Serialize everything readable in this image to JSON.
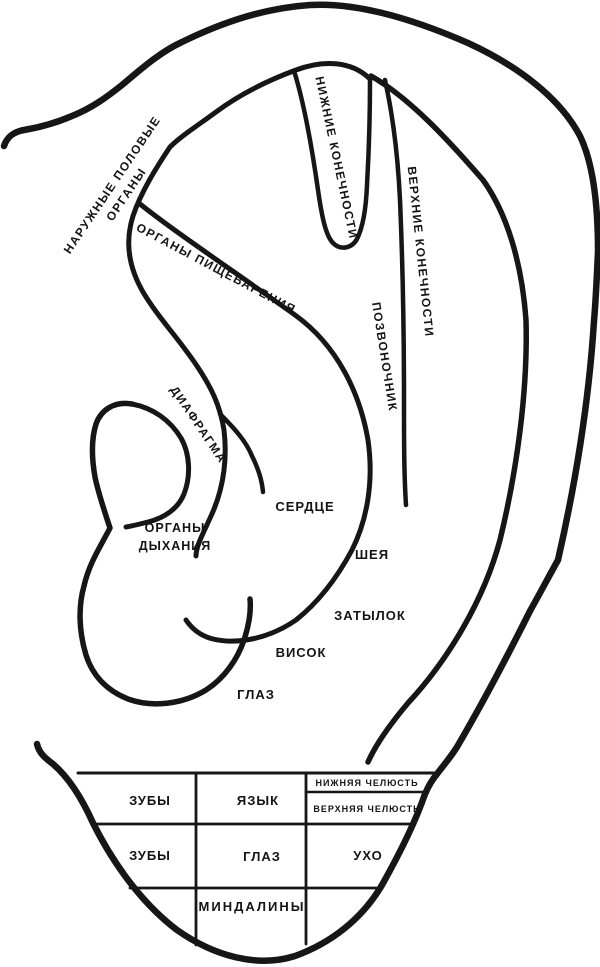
{
  "figure": {
    "description": "Ear reflexology zone map (auriculotherapy diagram of the auricle)",
    "language": "ru"
  },
  "colors": {
    "ink": "#161616",
    "background": "#ffffff"
  },
  "zone_labels": {
    "external_genital_organs": {
      "line1": "НАРУЖНЫЕ ПОЛОВЫЕ",
      "line2": "ОРГАНЫ"
    },
    "digestive_organs": "ОРГАНЫ ПИЩЕВАРЕНИЯ",
    "lower_limbs": "НИЖНИЕ КОНЕЧНОСТИ",
    "upper_limbs": "ВЕРХНИЕ КОНЕЧНОСТИ",
    "spine": "ПОЗВОНОЧНИК",
    "diaphragm": "ДИАФРАГМА",
    "heart": "СЕРДЦЕ",
    "respiratory_organs": {
      "line1": "ОРГАНЫ",
      "line2": "ДЫХАНИЯ"
    },
    "neck": "ШЕЯ",
    "occiput": "ЗАТЫЛОК",
    "temple": "ВИСОК",
    "eye": "ГЛАЗ"
  },
  "lobe_grid": {
    "teeth_upper": "ЗУБЫ",
    "tongue": "ЯЗЫК",
    "lower_jaw": "НИЖНЯЯ ЧЕЛЮСТЬ",
    "upper_jaw": "ВЕРХНЯЯ ЧЕЛЮСТЬ",
    "teeth_lower": "ЗУБЫ",
    "eye": "ГЛАЗ",
    "ear": "УХО",
    "tonsils": "МИНДАЛИНЫ"
  }
}
